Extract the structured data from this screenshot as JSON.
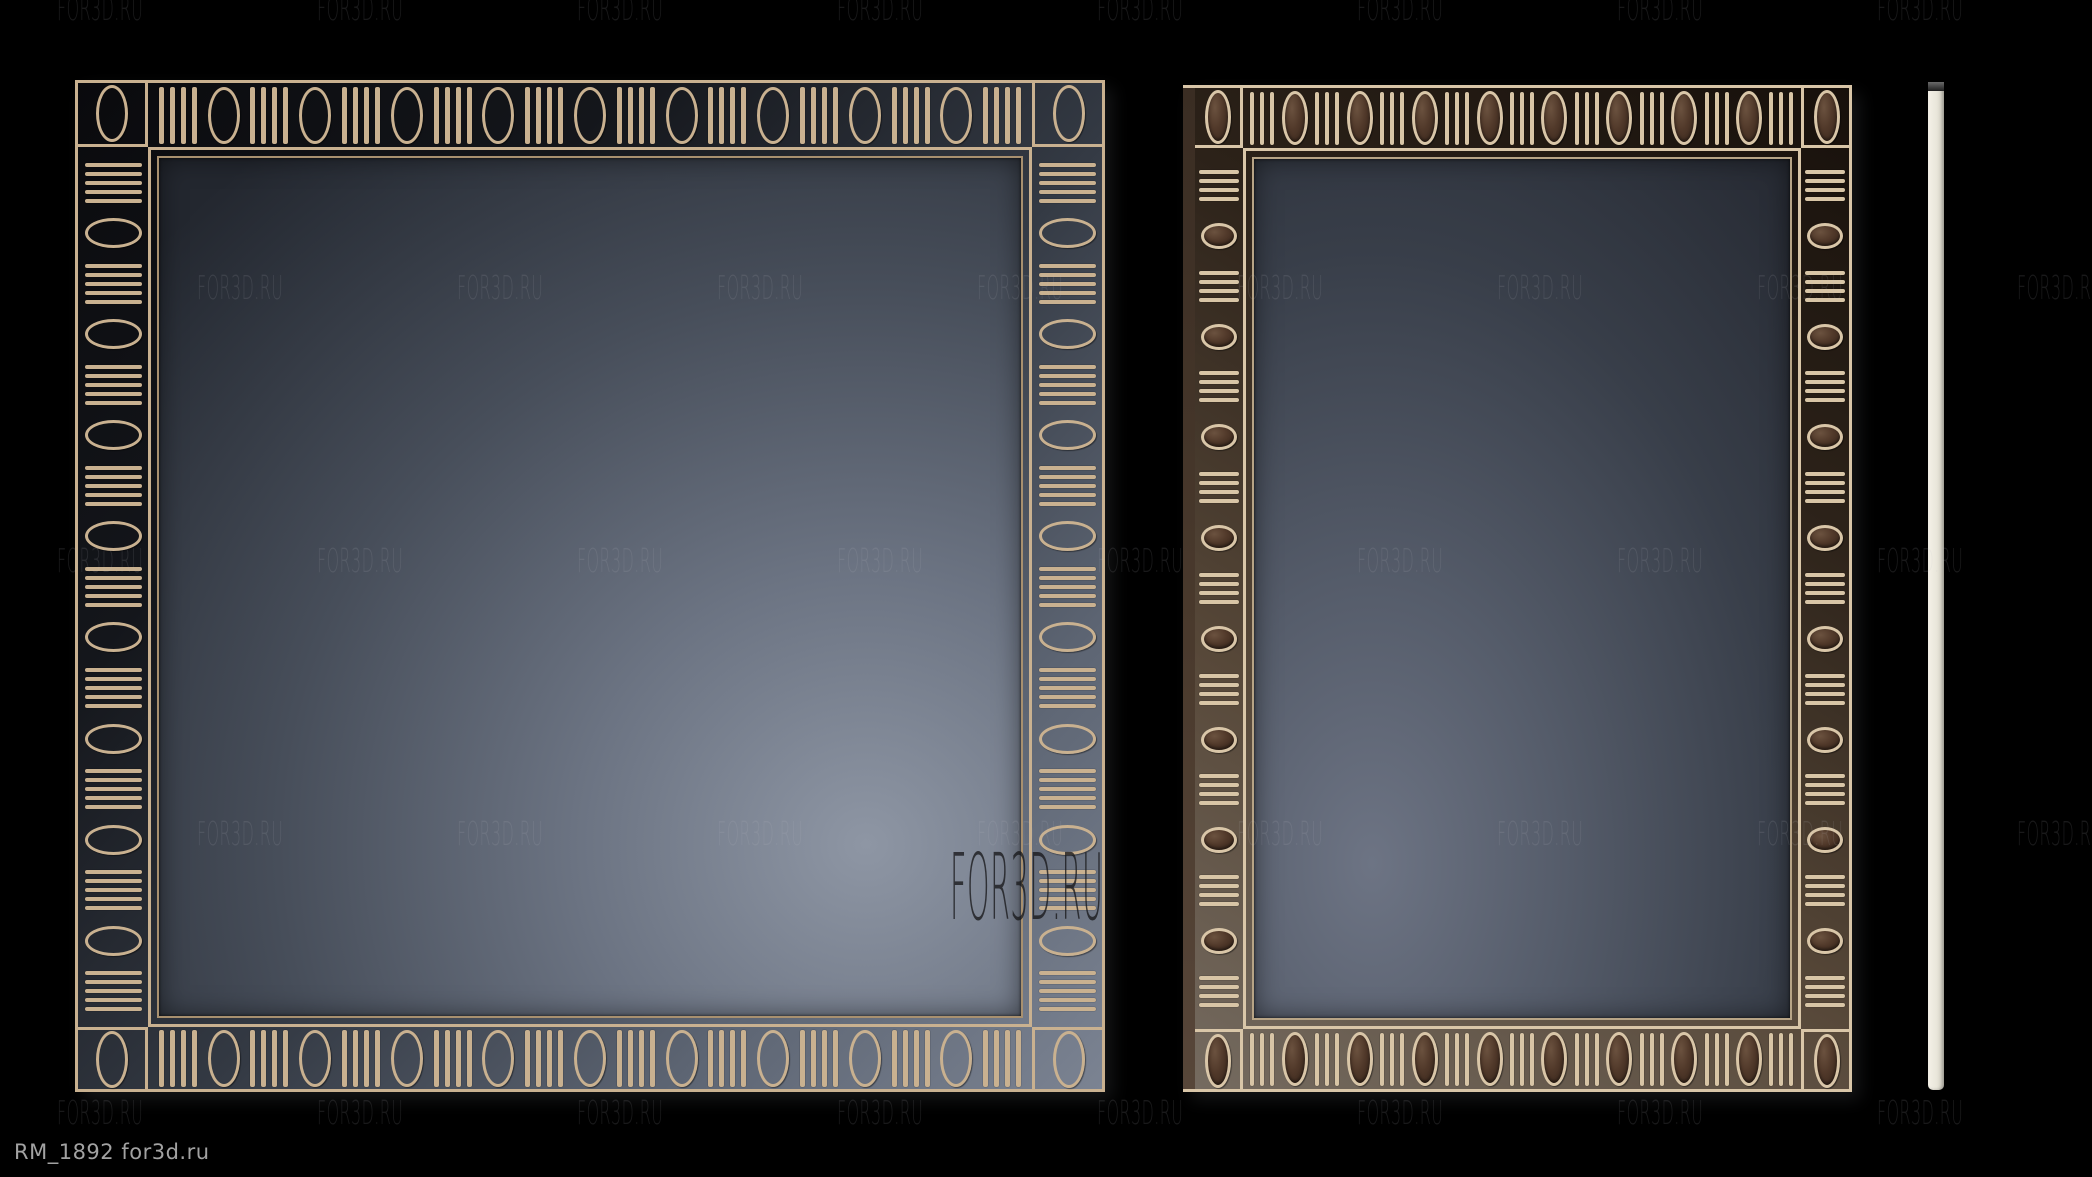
{
  "title_label": {
    "text": "RM_1892 for3d.ru"
  },
  "watermark": {
    "text": "FOR3D.RU",
    "small": {
      "spacing": 260,
      "rows": [
        {
          "y": -8,
          "x_start": 57
        },
        {
          "y": 271,
          "x_start": 197
        },
        {
          "y": 544,
          "x_start": 57
        },
        {
          "y": 817,
          "x_start": 197
        },
        {
          "y": 1096,
          "x_start": 57
        }
      ]
    },
    "large": {
      "text": "FOR3D.RU",
      "x": 950,
      "y": 842
    }
  },
  "colors": {
    "background": "#000000",
    "left_frame_ornament": "#c9b190",
    "left_frame_trim": "#a8906f",
    "right_frame_ornament": "#d9c6a8",
    "right_frame_wood": "#4a3a2d",
    "glass_left_center": "#8e96a4",
    "glass_left_edge": "#23272f",
    "glass_right_center": "#6d7484",
    "glass_right_edge": "#282c35",
    "side_profile": "#e9e6da",
    "label_text": "#a2a2a2"
  },
  "scene": {
    "frames": [
      {
        "name": "mirror-frame-left",
        "variant": "f-left",
        "oval_style": "outline",
        "top_bottom": {
          "bar_groups": 10,
          "bars_per_group": 4,
          "ovals": 9
        },
        "sides": {
          "bar_groups": 9,
          "bars_per_group": 5,
          "ovals": 8
        }
      },
      {
        "name": "mirror-frame-right",
        "variant": "f-right",
        "oval_style": "filled",
        "top_bottom": {
          "bar_groups": 9,
          "bars_per_group": 3,
          "ovals": 8
        },
        "sides": {
          "bar_groups": 9,
          "bars_per_group": 4,
          "ovals": 8
        }
      }
    ],
    "side_profile": {
      "name": "frame-side-profile"
    }
  }
}
